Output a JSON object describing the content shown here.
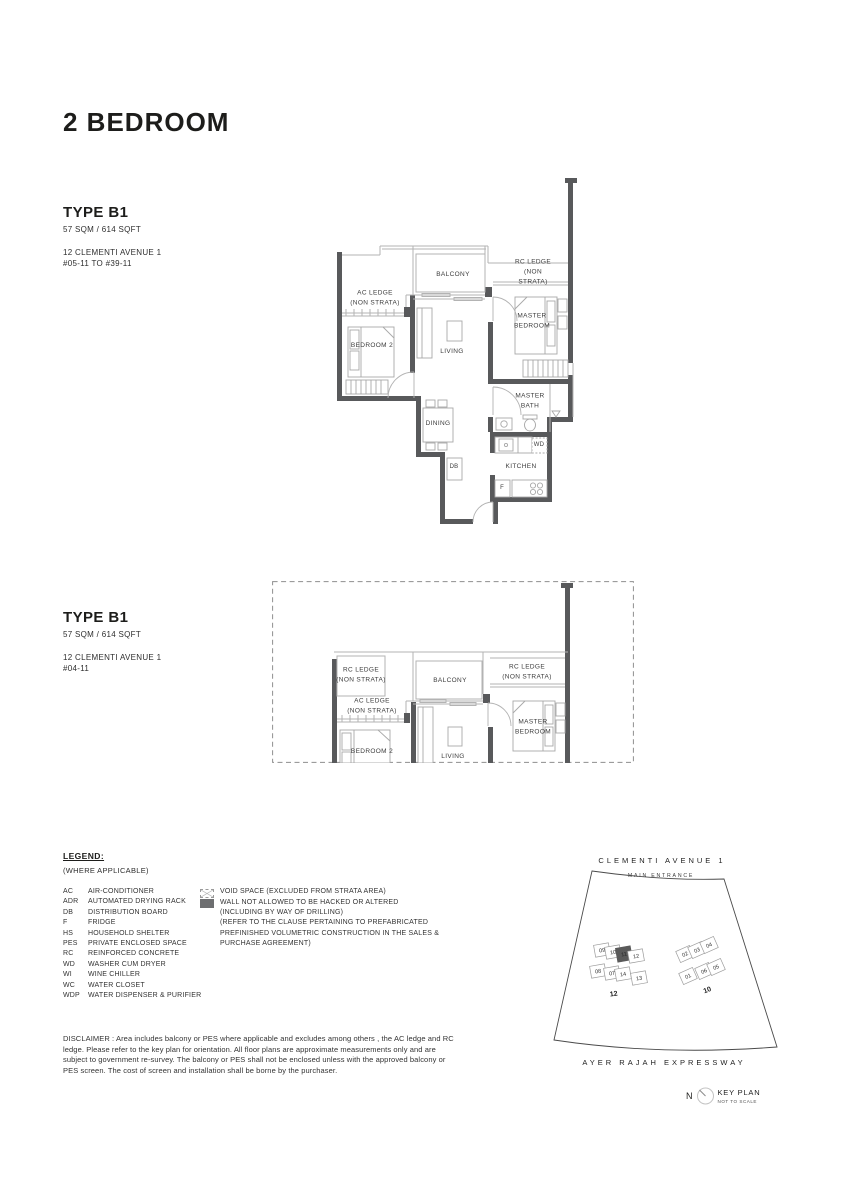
{
  "page_title": "2 BEDROOM",
  "units": [
    {
      "type": "TYPE B1",
      "area": "57 SQM / 614 SQFT",
      "address": "12 CLEMENTI AVENUE 1",
      "levels": "#05-11 TO #39-11"
    },
    {
      "type": "TYPE B1",
      "area": "57 SQM / 614 SQFT",
      "address": "12 CLEMENTI AVENUE 1",
      "levels": "#04-11"
    }
  ],
  "plan1": {
    "balcony": "BALCONY",
    "rc_ledge": "RC LEDGE\n(NON STRATA)",
    "ac_ledge": "AC LEDGE\n(NON STRATA)",
    "master_bedroom": "MASTER\nBEDROOM",
    "bedroom2": "BEDROOM 2",
    "living": "LIVING",
    "master_bath": "MASTER\nBATH",
    "dining": "DINING",
    "db": "DB",
    "wd": "WD",
    "kitchen": "KITCHEN",
    "fridge": "F"
  },
  "plan2": {
    "rc_ledge_left": "RC LEDGE\n(NON STRATA)",
    "balcony": "BALCONY",
    "rc_ledge_right": "RC LEDGE\n(NON STRATA)",
    "ac_ledge": "AC LEDGE\n(NON STRATA)",
    "master_bedroom": "MASTER\nBEDROOM",
    "bedroom2": "BEDROOM 2",
    "living": "LIVING"
  },
  "legend": {
    "title": "LEGEND:",
    "subtitle": "(WHERE APPLICABLE)",
    "items": [
      {
        "abbr": "AC",
        "desc": "AIR-CONDITIONER"
      },
      {
        "abbr": "ADR",
        "desc": "AUTOMATED DRYING RACK"
      },
      {
        "abbr": "DB",
        "desc": "DISTRIBUTION BOARD"
      },
      {
        "abbr": "F",
        "desc": "FRIDGE"
      },
      {
        "abbr": "HS",
        "desc": "HOUSEHOLD SHELTER"
      },
      {
        "abbr": "PES",
        "desc": "PRIVATE ENCLOSED SPACE"
      },
      {
        "abbr": "RC",
        "desc": "REINFORCED CONCRETE"
      },
      {
        "abbr": "WD",
        "desc": "WASHER CUM DRYER"
      },
      {
        "abbr": "WI",
        "desc": "WINE CHILLER"
      },
      {
        "abbr": "WC",
        "desc": "WATER CLOSET"
      },
      {
        "abbr": "WDP",
        "desc": "WATER DISPENSER & PURIFIER"
      }
    ],
    "symbols": [
      {
        "icon": "void-space-swatch",
        "text": "VOID SPACE (EXCLUDED FROM STRATA AREA)"
      },
      {
        "icon": "wall-swatch",
        "text": "WALL NOT ALLOWED TO BE HACKED OR ALTERED\n(INCLUDING BY WAY OF DRILLING)\n(REFER TO THE CLAUSE PERTAINING TO PREFABRICATED\nPREFINISHED VOLUMETRIC CONSTRUCTION IN THE SALES &\nPURCHASE AGREEMENT)"
      }
    ]
  },
  "disclaimer": "DISCLAIMER : Area includes balcony or PES where applicable and excludes among others , the AC ledge and RC ledge. Please refer to the key plan for orientation. All floor plans are approximate measurements only and are subject to government re-survey. The balcony or PES shall not be enclosed unless with the approved balcony or PES screen. The cost of screen and installation shall be borne by the purchaser.",
  "keyplan": {
    "road_top": "CLEMENTI AVENUE 1",
    "main_entrance": "MAIN ENTRANCE",
    "road_bottom": "AYER RAJAH EXPRESSWAY",
    "cluster_left_label": "12",
    "cluster_right_label": "10",
    "left_units": [
      "09",
      "10",
      "11",
      "12",
      "08",
      "07",
      "14",
      "13"
    ],
    "right_units": [
      "02",
      "03",
      "04",
      "01",
      "06",
      "05"
    ],
    "highlighted_unit": "11",
    "north_label": "N",
    "title": "KEY PLAN",
    "scale_note": "NOT TO SCALE"
  },
  "colors": {
    "wall": "#58595b",
    "thin_line": "#b3b3b3",
    "highlight_unit": "#5a5a5a"
  }
}
